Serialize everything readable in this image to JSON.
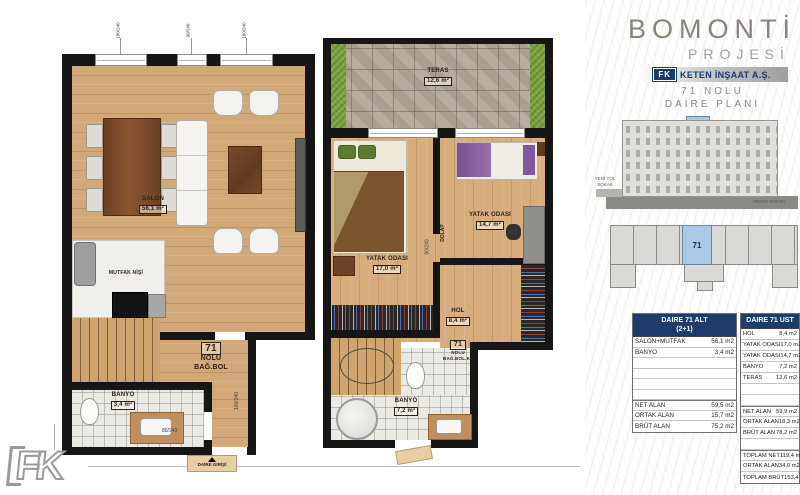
{
  "brand": {
    "title": "BOMONTİ",
    "subtitle": "PROJESİ",
    "logo_text": "FK",
    "company": "KETEN İNŞAAT A.Ş.",
    "caption_line1": "71 NOLU",
    "caption_line2": "DAİRE PLANI"
  },
  "elevation": {
    "unit": "71",
    "street_left_line1": "YENİ YOL",
    "street_left_line2": "SOKAK",
    "side_right": "PERPA TARAFI"
  },
  "site_plan": {
    "unit": "71"
  },
  "lower_plan": {
    "salon": {
      "name": "SALON",
      "area": "56,1 m²"
    },
    "kitchen": {
      "name": "MUTFAK NİŞİ"
    },
    "bath": {
      "name": "BANYO",
      "area": "3,4 m²"
    },
    "unit_tag": {
      "no": "71",
      "line1": "NOLU",
      "line2": "BAĞ.BOL"
    },
    "entrance": "DAİRE GİRİŞİ",
    "dims": {
      "window_left": "180/240",
      "window_mid": "90/240",
      "window_right": "180/240",
      "bath_door": "80/240",
      "side": "100/240"
    }
  },
  "upper_plan": {
    "terrace": {
      "name": "TERAS",
      "area": "12,6 m²"
    },
    "bedroom1": {
      "name": "YATAK ODASI",
      "area": "17,0 m²"
    },
    "bedroom2": {
      "name": "YATAK ODASI",
      "area": "14,7 m²"
    },
    "hall": {
      "name": "HOL",
      "area": "8,4 m²"
    },
    "bath": {
      "name": "BANYO",
      "area": "7,2 m²"
    },
    "unit_tag": {
      "no": "71",
      "line1": "NOLU",
      "line2": "BAĞ.BOL.KT"
    },
    "wardrobe": "DOLAP",
    "dims": {
      "door": "90/240"
    }
  },
  "tables": {
    "alt": {
      "title_line1": "DAIRE 71 ALT",
      "title_line2": "(2+1)",
      "rows": [
        {
          "label": "SALON+MUTFAK",
          "value": "56,1 m2"
        },
        {
          "label": "BANYO",
          "value": "3,4 m2"
        },
        {
          "label": "",
          "value": ""
        },
        {
          "label": "",
          "value": ""
        },
        {
          "label": "",
          "value": ""
        },
        {
          "label": "",
          "value": ""
        },
        {
          "label": "NET ALAN",
          "value": "59,5 m2"
        },
        {
          "label": "ORTAK ALAN",
          "value": "15,7 m2"
        },
        {
          "label": "BRÜT ALAN",
          "value": "75,2 m2"
        }
      ]
    },
    "ust": {
      "title": "DAIRE 71 UST",
      "rows": [
        {
          "label": "HOL",
          "value": "8,4 m2"
        },
        {
          "label": "YATAK ODASI",
          "value": "17,0 m2"
        },
        {
          "label": "YATAK ODASI",
          "value": "14,7 m2"
        },
        {
          "label": "BANYO",
          "value": "7,2 m2"
        },
        {
          "label": "TERAS",
          "value": "12,6 m2"
        },
        {
          "label": "",
          "value": ""
        },
        {
          "label": "",
          "value": ""
        },
        {
          "label": "NET ALAN",
          "value": "59,9 m2"
        },
        {
          "label": "ORTAK ALAN",
          "value": "18,3 m2"
        },
        {
          "label": "BRÜT ALAN",
          "value": "78,2 m2"
        },
        {
          "label": "",
          "value": ""
        },
        {
          "label": "TOPLAM NET",
          "value": "119,4 m2"
        },
        {
          "label": "ORTAK ALAN",
          "value": "34,0 m2"
        },
        {
          "label": "TOPLAM BRÜT",
          "value": "153,4 m2"
        }
      ]
    }
  },
  "footer": {
    "logo_text": "FK"
  },
  "colors": {
    "accent_navy": "#1e3c6b",
    "highlight_blue": "#a9c9e6",
    "wood": "#d2a878",
    "title_gray": "#8b8378"
  }
}
